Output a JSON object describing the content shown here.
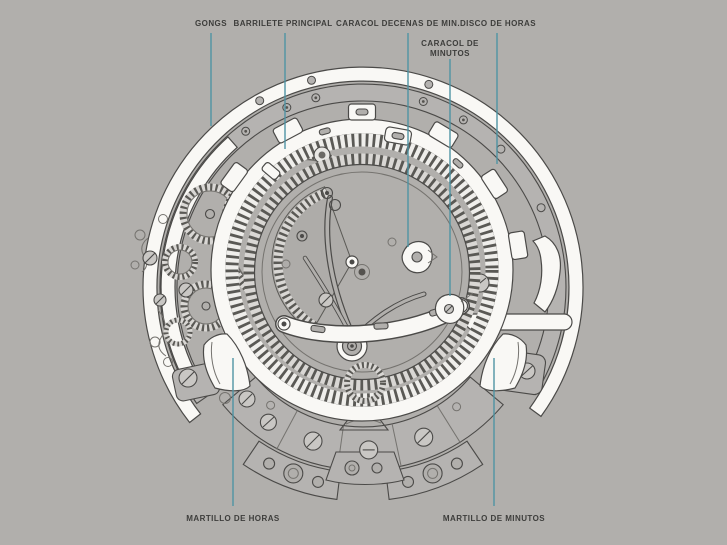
{
  "figure": {
    "labels": {
      "gongs": "GONGS",
      "barrilete": "BARRILETE PRINCIPAL",
      "caracol_decenas": "CARACOL DECENAS DE MIN.",
      "disco_horas": "DISCO DE HORAS",
      "caracol_minutos": "CARACOL DE MINUTOS",
      "martillo_horas": "MARTILLO DE HORAS",
      "martillo_minutos": "MARTILLO DE MINUTOS"
    }
  },
  "colors": {
    "background": "#b1afac",
    "leader_line": "#4d92a3",
    "label_text": "#3d3d3b",
    "line_art": "#4b4a48",
    "highlight_fill": "#f9f8f5",
    "plate_fill": "#b5b3b1"
  }
}
